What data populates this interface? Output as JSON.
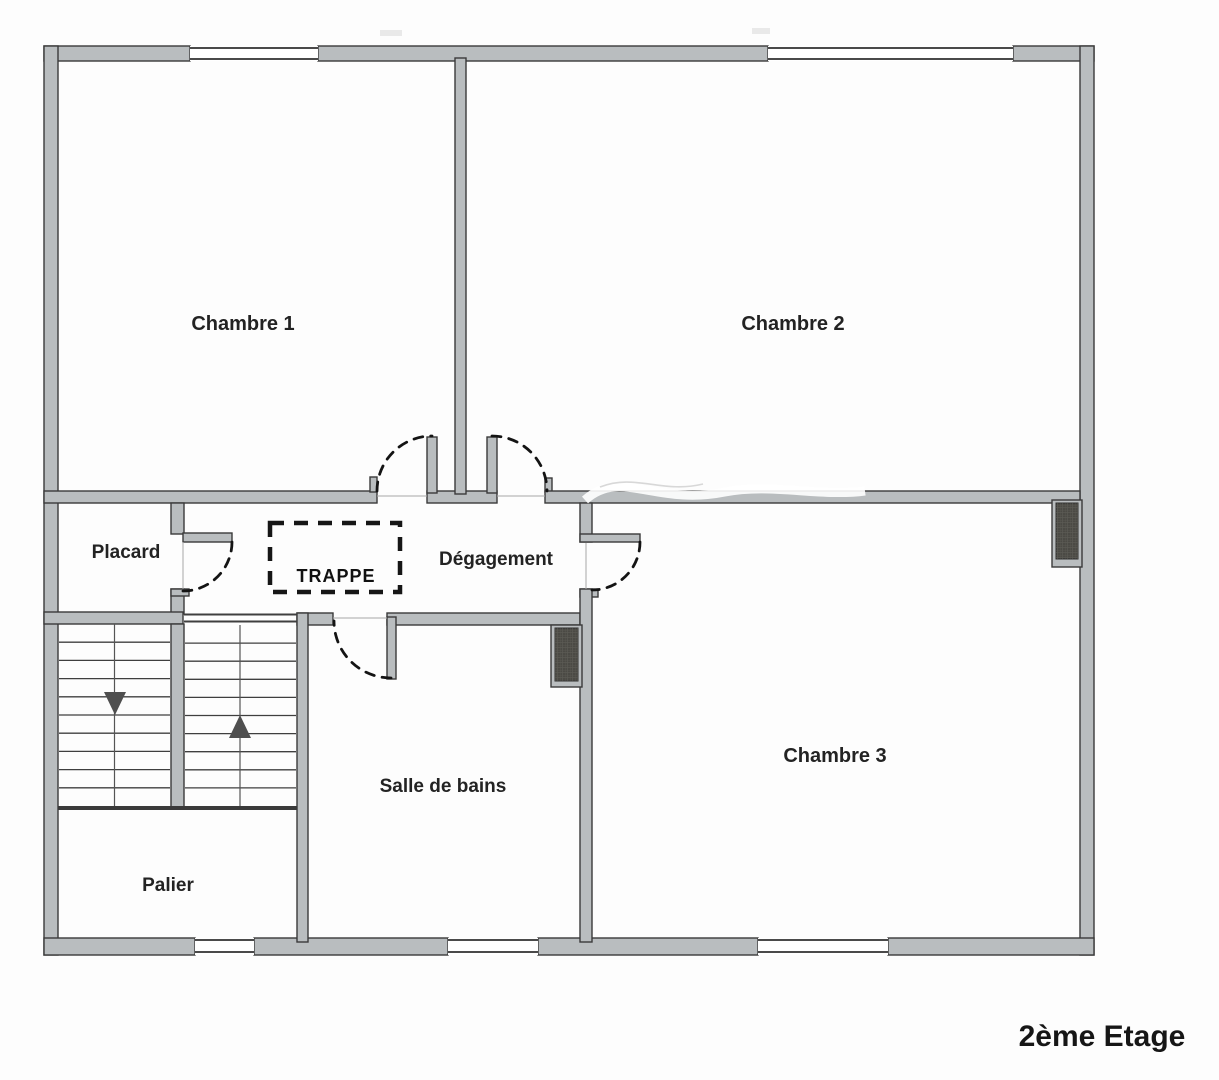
{
  "floor_label": "2ème Etage",
  "rooms": {
    "chambre1": "Chambre 1",
    "chambre2": "Chambre 2",
    "chambre3": "Chambre 3",
    "placard": "Placard",
    "degagement": "Dégagement",
    "trappe": "TRAPPE",
    "salle_de_bains": "Salle de bains",
    "palier": "Palier"
  },
  "stairs": {
    "steps_per_flight": 10,
    "left_flight_direction": "down",
    "right_flight_direction": "up"
  },
  "colors": {
    "wall_fill": "#b9bdbf",
    "wall_stroke": "#3a3a3a",
    "flue_fill": "#4b4a45",
    "arc_color": "#141414",
    "label_color": "#232323"
  }
}
